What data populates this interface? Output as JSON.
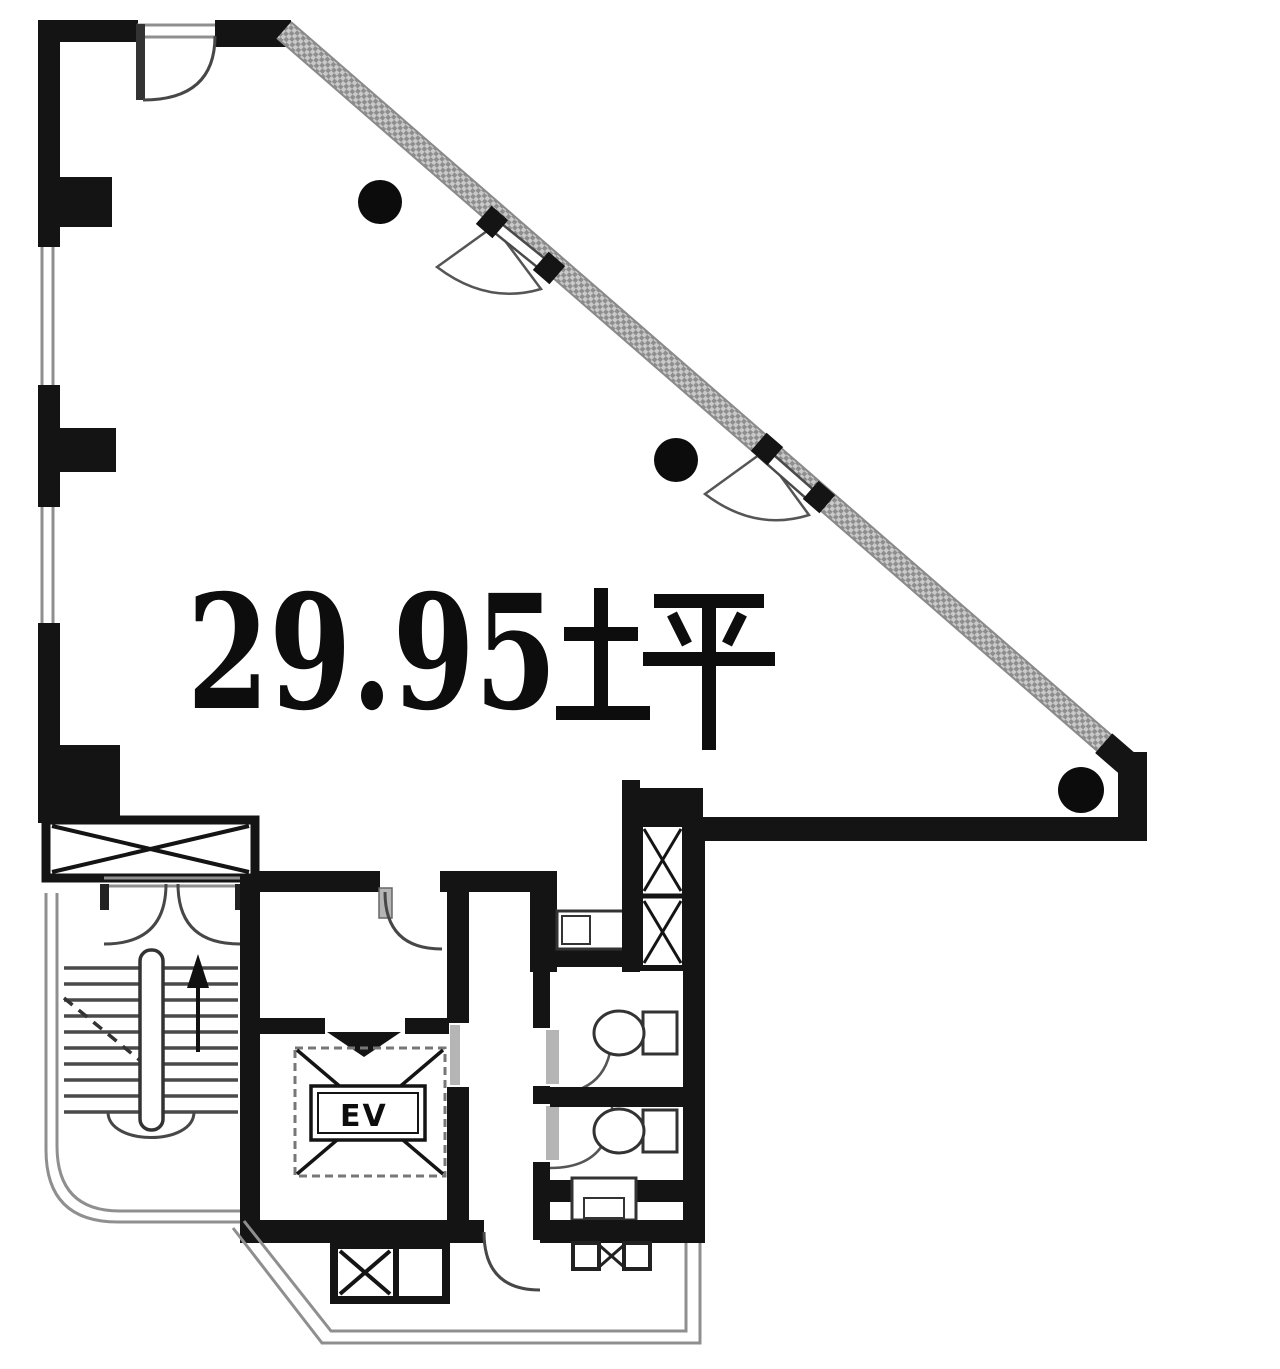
{
  "floor_plan": {
    "room": {
      "area_number": "29.95",
      "area_unit": "坪",
      "area_label": "29.95坪"
    },
    "elevator_label": "EV",
    "colors": {
      "wall": "#141414",
      "window_line": "#8f8f8f",
      "glass_band_dark": "#8e8e8e",
      "glass_band_light": "#c9c9c9",
      "background": "#ffffff"
    },
    "symbols": [
      "column-dot",
      "door-swing-arc",
      "glass-window-band",
      "x-braced-shaft",
      "stair-up-arrow",
      "elevator-cab",
      "toilet-fixture",
      "entrance-porch"
    ]
  }
}
